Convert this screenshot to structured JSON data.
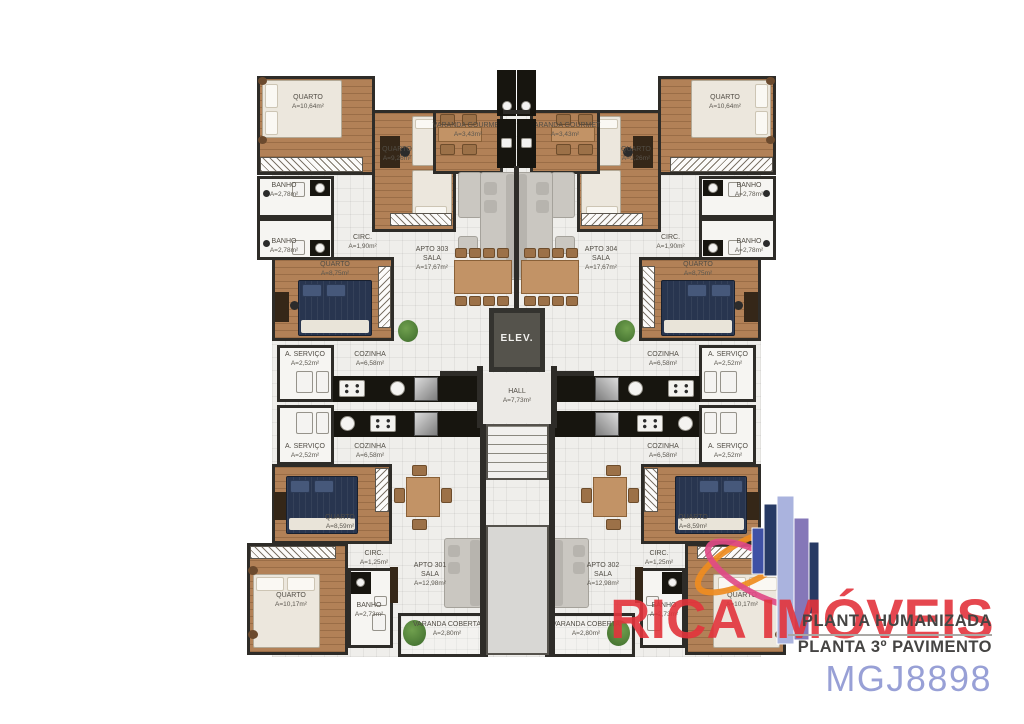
{
  "watermark": {
    "brand": "RICA IMÓVEIS",
    "brand_color": "#e3343c",
    "caption_line1": "PLANTA HUMANIZADA",
    "caption_line2": "PLANTA 3º PAVIMENTO",
    "code": "MGJ8898",
    "code_color": "#98a0d6"
  },
  "common": {
    "elevator_label": "ELEV.",
    "hall": {
      "name": "HALL",
      "area": "A=7,73m²"
    }
  },
  "apartments": {
    "apt303": {
      "id": "APTO 303",
      "sala": {
        "name": "SALA",
        "area": "A=17,67m²"
      },
      "quarto_corner": {
        "name": "QUARTO",
        "area": "A=10,64m²"
      },
      "quarto_inner": {
        "name": "QUARTO",
        "area": "A=9,26m²"
      },
      "quarto_mid": {
        "name": "QUARTO",
        "area": "A=8,75m²"
      },
      "banho_1": {
        "name": "BANHO",
        "area": "A=2,78m²"
      },
      "banho_2": {
        "name": "BANHO",
        "area": "A=2,78m²"
      },
      "circ": {
        "name": "CIRC.",
        "area": "A=1,90m²"
      },
      "servico": {
        "name": "A. SERVIÇO",
        "area": "A=2,52m²"
      },
      "cozinha": {
        "name": "COZINHA",
        "area": "A=6,58m²"
      },
      "varanda_gourmet": {
        "name": "VARANDA GOURMET",
        "area": "A=3,43m²"
      }
    },
    "apt304": {
      "id": "APTO 304",
      "sala": {
        "name": "SALA",
        "area": "A=17,67m²"
      },
      "quarto_corner": {
        "name": "QUARTO",
        "area": "A=10,64m²"
      },
      "quarto_inner": {
        "name": "QUARTO",
        "area": "A=9,26m²"
      },
      "quarto_mid": {
        "name": "QUARTO",
        "area": "A=8,75m²"
      },
      "banho_1": {
        "name": "BANHO",
        "area": "A=2,78m²"
      },
      "banho_2": {
        "name": "BANHO",
        "area": "A=2,78m²"
      },
      "circ": {
        "name": "CIRC.",
        "area": "A=1,90m²"
      },
      "servico": {
        "name": "A. SERVIÇO",
        "area": "A=2,52m²"
      },
      "cozinha": {
        "name": "COZINHA",
        "area": "A=6,58m²"
      },
      "varanda_gourmet": {
        "name": "VARANDA GOURMET",
        "area": "A=3,43m²"
      }
    },
    "apt301": {
      "id": "APTO 301",
      "sala": {
        "name": "SALA",
        "area": "A=12,98m²"
      },
      "quarto_mid": {
        "name": "QUARTO",
        "area": "A=8,59m²"
      },
      "quarto_corner": {
        "name": "QUARTO",
        "area": "A=10,17m²"
      },
      "banho": {
        "name": "BANHO",
        "area": "A=2,73m²"
      },
      "circ": {
        "name": "CIRC.",
        "area": "A=1,25m²"
      },
      "servico": {
        "name": "A. SERVIÇO",
        "area": "A=2,52m²"
      },
      "cozinha": {
        "name": "COZINHA",
        "area": "A=6,58m²"
      },
      "varanda_coberta": {
        "name": "VARANDA COBERTA",
        "area": "A=2,80m²"
      }
    },
    "apt302": {
      "id": "APTO 302",
      "sala": {
        "name": "SALA",
        "area": "A=12,98m²"
      },
      "quarto_mid": {
        "name": "QUARTO",
        "area": "A=8,59m²"
      },
      "quarto_corner": {
        "name": "QUARTO",
        "area": "A=10,17m²"
      },
      "banho": {
        "name": "BANHO",
        "area": "A=2,73m²"
      },
      "circ": {
        "name": "CIRC.",
        "area": "A=1,25m²"
      },
      "servico": {
        "name": "A. SERVIÇO",
        "area": "A=2,52m²"
      },
      "cozinha": {
        "name": "COZINHA",
        "area": "A=6,58m²"
      },
      "varanda_coberta": {
        "name": "VARANDA COBERTA",
        "area": "A=2,80m²"
      }
    }
  }
}
